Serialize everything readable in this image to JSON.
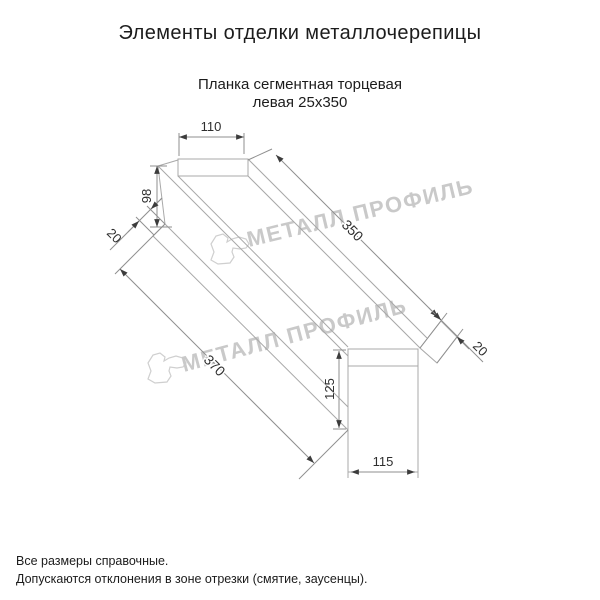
{
  "header": {
    "title": "Элементы отделки металлочерепицы",
    "subtitle_line1": "Планка сегментная торцевая",
    "subtitle_line2": "левая 25х350"
  },
  "drawing": {
    "watermark_text": "МЕТАЛЛ ПРОФИЛЬ",
    "dimensions": {
      "top_tab_width": "110",
      "left_end_height": "98",
      "left_fold": "20",
      "length_top": "350",
      "right_fold": "20",
      "length_bottom": "370",
      "end_tab_height": "125",
      "end_tab_width": "115"
    }
  },
  "footer": {
    "note1": "Все размеры справочные.",
    "note2": "Допускаются отклонения в зоне отрезки (смятие, заусенцы)."
  },
  "colors": {
    "background": "#ffffff",
    "outline_line": "#a8a8a8",
    "dimension_line": "#8f8f8f",
    "arrow": "#3c3c3c",
    "dimension_text": "#2e2e2e",
    "title_text": "#1c1c1c",
    "watermark": "#c9c9c9"
  }
}
